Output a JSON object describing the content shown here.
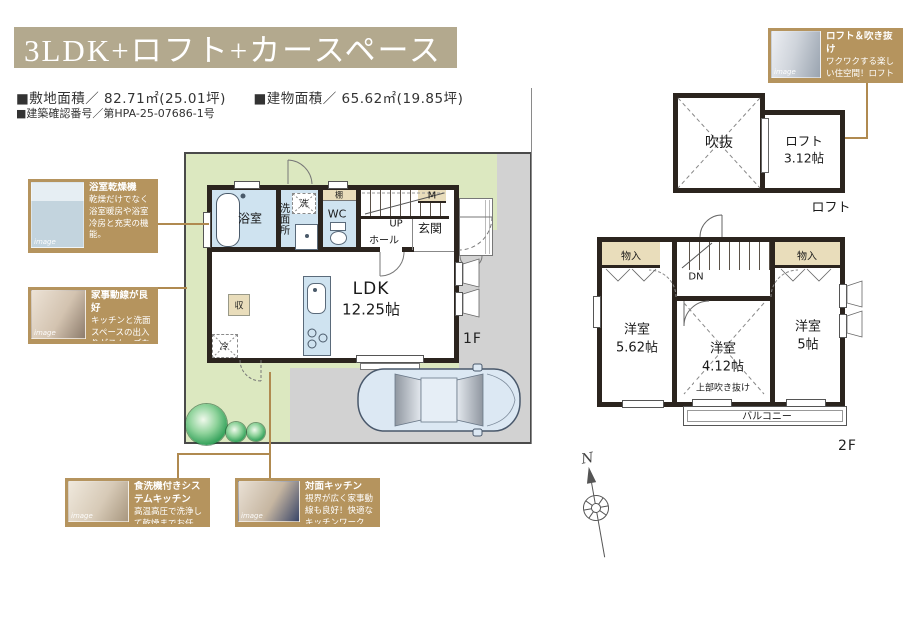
{
  "header": {
    "title": "3LDK+ロフト+カースペース",
    "spec_site": "■敷地面積／ 82.71㎡(25.01坪)",
    "spec_building": "■建物面積／ 65.62㎡(19.85坪)",
    "spec_confirmation": "■建築確認番号／第HPA-25-07686-1号"
  },
  "callouts": {
    "loft": {
      "title": "ロフト＆吹き抜け",
      "body": "ワクワクする楽しい住空間！ロフトがあるプラン。",
      "wm": "image"
    },
    "bath_dryer": {
      "title": "浴室乾燥機",
      "body": "乾燥だけでなく浴室暖房や浴室冷房と充実の機能。",
      "wm": "image"
    },
    "housework": {
      "title": "家事動線が良好",
      "body": "キッチンと洗面スペースの出入りがスムーズなプラン。",
      "wm": "image"
    },
    "dishwasher": {
      "title": "食洗機付きシステムキッチン",
      "body": "高温高圧で洗浄して乾燥までお任せ！",
      "wm": "image"
    },
    "face_kitchen": {
      "title": "対面キッチン",
      "body": "視界が広く家事動線も良好！快適なキッチンワークを。",
      "wm": "image"
    }
  },
  "plan1f": {
    "floor": "1F",
    "ldk": "LDK",
    "ldk_size": "12.25帖",
    "bath": "浴室",
    "washroom": "洗面所",
    "washer": "洗",
    "shelf": "棚",
    "wc": "WC",
    "up": "UP",
    "meter": "M",
    "hall": "ホール",
    "entrance": "玄関",
    "storage": "収",
    "fridge": "冷"
  },
  "plan2f": {
    "floor": "2F",
    "closet_l": "物入",
    "closet_r": "物入",
    "dn": "DN",
    "room_w": "洋室",
    "room_w_size": "5.62帖",
    "room_c": "洋室",
    "room_c_size": "4.12帖",
    "room_c_note": "上部吹き抜け",
    "room_e": "洋室",
    "room_e_size": "5帖",
    "balcony": "バルコニー"
  },
  "loft_plan": {
    "void": "吹抜",
    "room": "ロフト",
    "size": "3.12帖",
    "caption": "ロフト"
  },
  "compass": {
    "n": "N"
  },
  "colors": {
    "title_bar": "#b3a98e",
    "callout_bg": "#b5945e",
    "wall": "#2b241e",
    "wet_floor": "#cfe3f0",
    "closet_tan": "#e9ddbb",
    "site_green": "#dce8c0",
    "pavement_gray": "#d2d2d2",
    "connector_gold": "#b08a50"
  }
}
